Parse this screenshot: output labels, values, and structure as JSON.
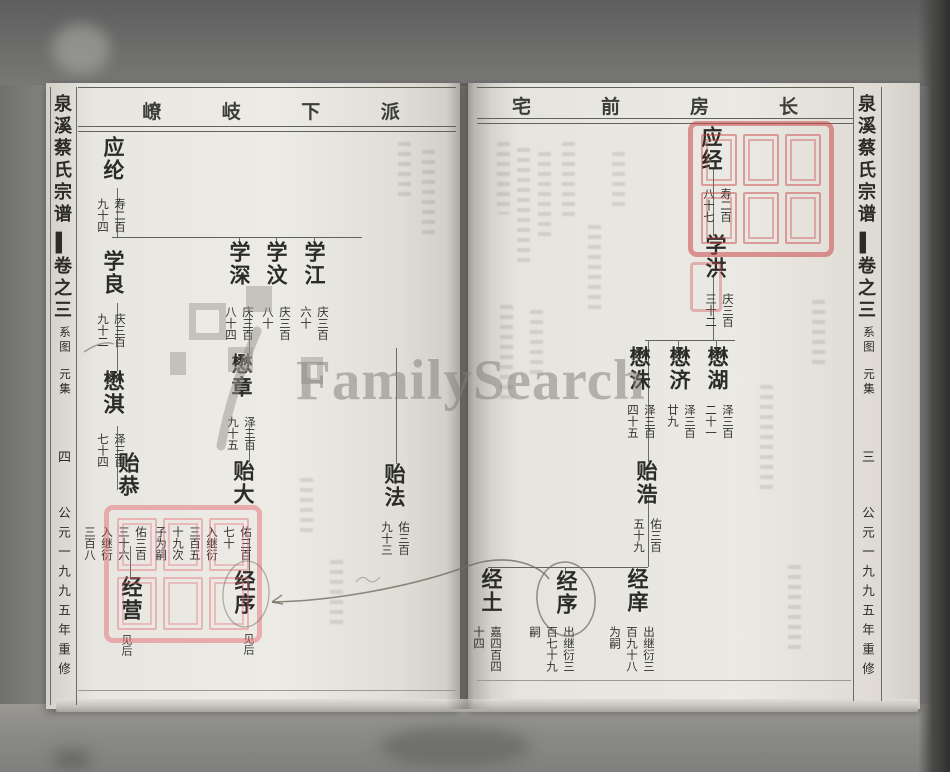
{
  "watermark": {
    "text": "FamilySearch"
  },
  "book": {
    "left_page": {
      "spine": {
        "title": "泉溪蔡氏宗谱",
        "volume": "▌卷之三",
        "section": "系图",
        "collection": "元集",
        "page_number": "四",
        "edition": "公元一九九五年重修"
      },
      "header": {
        "c1": "嶛",
        "c2": "岐",
        "c3": "下",
        "c4": "派"
      },
      "nodes": {
        "ying_lun": {
          "name": "应纶",
          "ann": "寿二百\n九十四"
        },
        "xue_liang": {
          "name": "学良",
          "ann": "庆三百\n九十二"
        },
        "mao_qi": {
          "name": "懋淇",
          "ann": "泽三百\n七十四"
        },
        "yi_gong": {
          "name": "贻恭",
          "ann": "佑三百\n三十六\n入继衍\n三百八"
        },
        "jing_ying": {
          "name": "经营",
          "note": "见后"
        },
        "xue_shen": {
          "name": "学深",
          "ann": "庆三百\n八十四"
        },
        "mao_zhang": {
          "name": "懋章",
          "ann": "泽三百\n九十五"
        },
        "yi_da": {
          "name": "贻大",
          "ann": "佑三百\n七十\n入继衍\n三百五\n十九次\n子为嗣"
        },
        "jing_xu": {
          "name": "经序",
          "note": "见后"
        },
        "xue_wen": {
          "name": "学汶",
          "ann": "庆三百\n八十"
        },
        "xue_jiang": {
          "name": "学江",
          "ann": "庆三百\n六十"
        },
        "yi_fa": {
          "name": "贻法",
          "ann": "佑三百\n九十三"
        }
      }
    },
    "right_page": {
      "spine": {
        "title": "泉溪蔡氏宗谱",
        "volume": "▌卷之三",
        "section": "系图",
        "collection": "元集",
        "page_number": "三",
        "edition": "公元一九九五年重修"
      },
      "header": {
        "c1": "宅",
        "c2": "前",
        "c3": "房",
        "c4": "长"
      },
      "nodes": {
        "ying_jing": {
          "name": "应经",
          "ann": "寿二百\n八十七"
        },
        "xue_hong": {
          "name": "学洪",
          "ann": "庆三百\n三十二"
        },
        "mao_hu": {
          "name": "懋湖",
          "ann": "泽三百\n二十一"
        },
        "mao_ji": {
          "name": "懋济",
          "ann": "泽三百\n廿九"
        },
        "mao_zhu": {
          "name": "懋洙",
          "ann": "泽三百\n四十五"
        },
        "yi_hao": {
          "name": "贻浩",
          "ann": "佑三百\n五十九"
        },
        "jing_xiang": {
          "name": "经庠",
          "ann": "出继衍三\n百九十八\n为嗣"
        },
        "jing_xu": {
          "name": "经序",
          "ann": "出继衍三\n百七十九\n嗣"
        },
        "jing_tu": {
          "name": "经土",
          "ann": "嘉四百四\n十四"
        }
      }
    }
  }
}
